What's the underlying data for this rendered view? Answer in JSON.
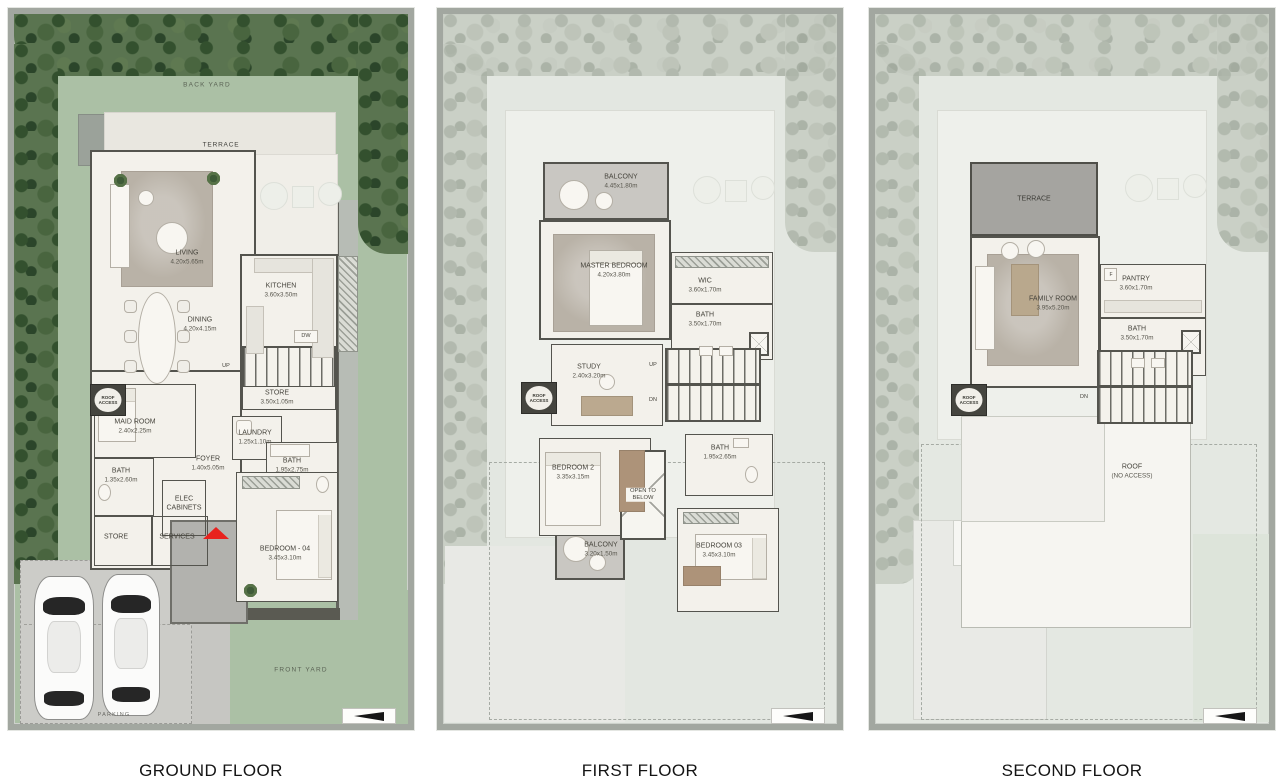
{
  "palette": {
    "yard_green": "#abc0a5",
    "ghost_yard": "#e3e7e1",
    "wall": "#54544e",
    "building": "#f3f1eb",
    "terrace_gray": "#a5a4a0",
    "balcony_gray": "#c9c7c2",
    "entry_red": "#e8221e",
    "asphalt": "#ccccc8"
  },
  "floors": [
    {
      "title": "GROUND FLOOR",
      "yard": {
        "back": "BACK YARD",
        "terrace": "TERRACE",
        "front": "FRONT YARD",
        "parking": "PARKING"
      },
      "stairs": {
        "up": "UP"
      },
      "appliance": {
        "dw": "DW"
      },
      "roof_access": "ROOF ACCESS",
      "rooms": {
        "living": {
          "name": "LIVING",
          "dims": "4.20x5.65m"
        },
        "kitchen": {
          "name": "KITCHEN",
          "dims": "3.60x3.50m"
        },
        "dining": {
          "name": "DINING",
          "dims": "4.20x4.15m"
        },
        "store": {
          "name": "STORE",
          "dims": "3.50x1.05m"
        },
        "maid": {
          "name": "MAID ROOM",
          "dims": "2.40x2.25m"
        },
        "laundry": {
          "name": "LAUNDRY",
          "dims": "1.25x1.10m"
        },
        "bath_a": {
          "name": "BATH",
          "dims": "1.95x2.75m"
        },
        "foyer": {
          "name": "FOYER",
          "dims": "1.40x5.05m"
        },
        "bath_b": {
          "name": "BATH",
          "dims": "1.35x2.60m"
        },
        "elec": {
          "name": "ELEC CABINETS"
        },
        "store_b": {
          "name": "STORE"
        },
        "services": {
          "name": "SERVICES"
        },
        "bedroom04": {
          "name": "BEDROOM - 04",
          "dims": "3.45x3.10m"
        }
      }
    },
    {
      "title": "FIRST FLOOR",
      "stairs": {
        "up": "UP",
        "dn": "DN"
      },
      "roof_access": "ROOF ACCESS",
      "rooms": {
        "balcony_a": {
          "name": "BALCONY",
          "dims": "4.45x1.80m"
        },
        "master": {
          "name": "MASTER BEDROOM",
          "dims": "4.20x3.80m"
        },
        "wic": {
          "name": "WIC",
          "dims": "3.60x1.70m"
        },
        "bath_a": {
          "name": "BATH",
          "dims": "3.50x1.70m"
        },
        "study": {
          "name": "STUDY",
          "dims": "2.40x3.20m"
        },
        "bedroom2": {
          "name": "BEDROOM 2",
          "dims": "3.35x3.15m"
        },
        "open_below": {
          "name": "OPEN TO BELOW"
        },
        "bath_b": {
          "name": "BATH",
          "dims": "1.95x2.65m"
        },
        "balcony_b": {
          "name": "BALCONY",
          "dims": "3.20x1.50m"
        },
        "bedroom3": {
          "name": "BEDROOM 03",
          "dims": "3.45x3.10m"
        }
      }
    },
    {
      "title": "SECOND FLOOR",
      "stairs": {
        "dn": "DN"
      },
      "roof_access": "ROOF ACCESS",
      "appliance": {
        "fridge": "F"
      },
      "rooms": {
        "terrace": {
          "name": "TERRACE"
        },
        "family": {
          "name": "FAMILY ROOM",
          "dims": "3.95x5.20m"
        },
        "pantry": {
          "name": "PANTRY",
          "dims": "3.60x1.70m"
        },
        "bath": {
          "name": "BATH",
          "dims": "3.50x1.70m"
        },
        "roof": {
          "name": "ROOF",
          "dims": "(NO ACCESS)"
        }
      }
    }
  ]
}
